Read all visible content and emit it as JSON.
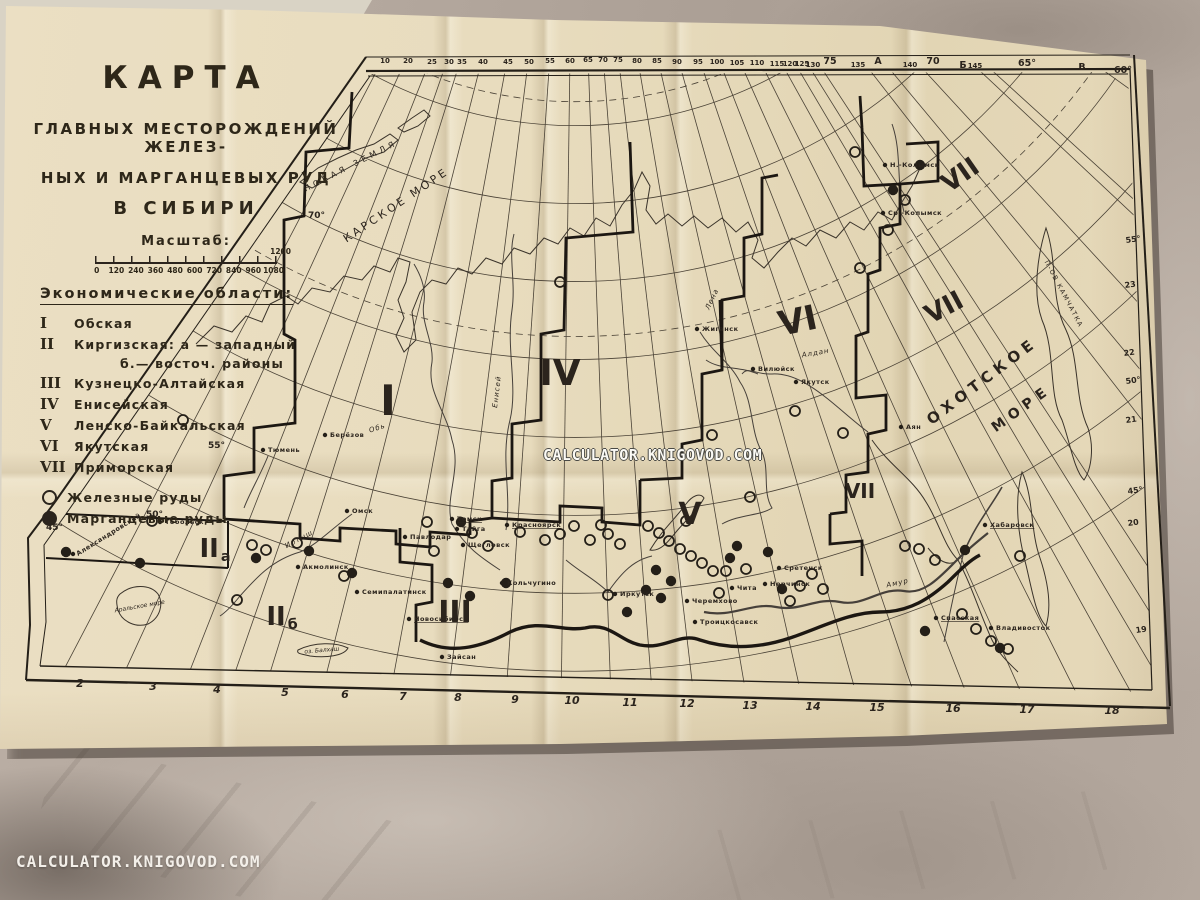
{
  "watermark": {
    "center": "CALCULATOR.KNIGOVOD.COM",
    "bottom_left": "CALCULATOR.KNIGOVOD.COM"
  },
  "colors": {
    "paper": "#e7dcbe",
    "ink": "#2b241d",
    "thin_line": "#3e372c",
    "table": "#b2a69c",
    "watermark_text": "#f6f3ec"
  },
  "title_block": {
    "title": "КАРТА",
    "subtitle_lines": [
      "ГЛАВНЫХ  МЕСТОРОЖДЕНИЙ  ЖЕЛЕЗ-",
      "НЫХ  И  МАРГАНЦЕВЫХ  РУД",
      "В  СИБИРИ"
    ],
    "scale_label": "Масштаб:",
    "scale_ticks": [
      "0",
      "120",
      "240",
      "360",
      "480",
      "600",
      "720",
      "840",
      "960",
      "1080"
    ],
    "scale_end": "1200"
  },
  "legend": {
    "heading": "Экономические области:",
    "items": [
      {
        "numeral": "I",
        "name": "Обская",
        "indent": false
      },
      {
        "numeral": "II",
        "name": "Киргизская: а — западный",
        "indent": false
      },
      {
        "numeral": "",
        "name": "б.— восточ. районы",
        "indent": true
      },
      {
        "numeral": "III",
        "name": "Кузнецко-Алтайская",
        "indent": false
      },
      {
        "numeral": "IV",
        "name": "Енисейская",
        "indent": false
      },
      {
        "numeral": "V",
        "name": "Ленско-Байкальская",
        "indent": false
      },
      {
        "numeral": "VI",
        "name": "Якутская",
        "indent": false
      },
      {
        "numeral": "VII",
        "name": "Приморская",
        "indent": false
      }
    ],
    "ore_items": [
      {
        "type": "iron",
        "label": "Железные руды"
      },
      {
        "type": "manganese",
        "label": "Марганцевые руды"
      }
    ]
  },
  "map": {
    "meridian_top_x": [
      385,
      408,
      432,
      449,
      462,
      483,
      508,
      529,
      550,
      570,
      588,
      603,
      618,
      637,
      657,
      677,
      698,
      717,
      737,
      757,
      777,
      790,
      802,
      813,
      858,
      878,
      910,
      963,
      975,
      1082
    ],
    "parallel_radii": [
      426,
      504,
      582,
      660,
      738,
      816,
      894,
      972
    ],
    "dashed_radii": [
      402,
      637
    ],
    "top_edge": [
      {
        "t": "10",
        "x": 385,
        "y": 63
      },
      {
        "t": "20",
        "x": 408,
        "y": 63
      },
      {
        "t": "25",
        "x": 432,
        "y": 64
      },
      {
        "t": "30",
        "x": 449,
        "y": 64
      },
      {
        "t": "35",
        "x": 462,
        "y": 64
      },
      {
        "t": "40",
        "x": 483,
        "y": 64
      },
      {
        "t": "45",
        "x": 508,
        "y": 64
      },
      {
        "t": "50",
        "x": 529,
        "y": 64
      },
      {
        "t": "55",
        "x": 550,
        "y": 63
      },
      {
        "t": "60",
        "x": 570,
        "y": 63
      },
      {
        "t": "65",
        "x": 588,
        "y": 62
      },
      {
        "t": "70",
        "x": 603,
        "y": 62
      },
      {
        "t": "75",
        "x": 618,
        "y": 62
      },
      {
        "t": "80",
        "x": 637,
        "y": 63
      },
      {
        "t": "85",
        "x": 657,
        "y": 63
      },
      {
        "t": "90",
        "x": 677,
        "y": 64
      },
      {
        "t": "95",
        "x": 698,
        "y": 64
      },
      {
        "t": "100",
        "x": 717,
        "y": 64
      },
      {
        "t": "105",
        "x": 737,
        "y": 65
      },
      {
        "t": "110",
        "x": 757,
        "y": 65
      },
      {
        "t": "115",
        "x": 777,
        "y": 66
      },
      {
        "t": "120",
        "x": 790,
        "y": 66
      },
      {
        "t": "125",
        "x": 802,
        "y": 66
      },
      {
        "t": "130",
        "x": 813,
        "y": 67
      },
      {
        "t": "75",
        "x": 830,
        "y": 64,
        "big": 1
      },
      {
        "t": "135",
        "x": 858,
        "y": 67
      },
      {
        "t": "А",
        "x": 878,
        "y": 64,
        "big": 1
      },
      {
        "t": "140",
        "x": 910,
        "y": 67
      },
      {
        "t": "70",
        "x": 933,
        "y": 64,
        "big": 1
      },
      {
        "t": "Б",
        "x": 963,
        "y": 68,
        "big": 1
      },
      {
        "t": "145",
        "x": 975,
        "y": 68
      },
      {
        "t": "65°",
        "x": 1027,
        "y": 66,
        "big": 1
      },
      {
        "t": "В",
        "x": 1082,
        "y": 70,
        "big": 1
      },
      {
        "t": "60°",
        "x": 1123,
        "y": 73,
        "big": 1
      }
    ],
    "bottom_edge": [
      {
        "t": "2",
        "x": 80,
        "y": 676
      },
      {
        "t": "3",
        "x": 153,
        "y": 679
      },
      {
        "t": "4",
        "x": 217,
        "y": 682
      },
      {
        "t": "5",
        "x": 285,
        "y": 685
      },
      {
        "t": "6",
        "x": 345,
        "y": 687
      },
      {
        "t": "7",
        "x": 403,
        "y": 689
      },
      {
        "t": "8",
        "x": 458,
        "y": 690
      },
      {
        "t": "9",
        "x": 515,
        "y": 692
      },
      {
        "t": "10",
        "x": 572,
        "y": 693
      },
      {
        "t": "11",
        "x": 630,
        "y": 695
      },
      {
        "t": "12",
        "x": 687,
        "y": 696
      },
      {
        "t": "13",
        "x": 750,
        "y": 698
      },
      {
        "t": "14",
        "x": 813,
        "y": 699
      },
      {
        "t": "15",
        "x": 877,
        "y": 700
      },
      {
        "t": "16",
        "x": 953,
        "y": 701
      },
      {
        "t": "17",
        "x": 1027,
        "y": 702
      },
      {
        "t": "18",
        "x": 1112,
        "y": 703
      }
    ],
    "right_edge": [
      {
        "t": "55°",
        "x": 1126,
        "y": 243
      },
      {
        "t": "23",
        "x": 1125,
        "y": 288
      },
      {
        "t": "22",
        "x": 1124,
        "y": 356
      },
      {
        "t": "50°",
        "x": 1126,
        "y": 384
      },
      {
        "t": "21",
        "x": 1126,
        "y": 423
      },
      {
        "t": "45°",
        "x": 1128,
        "y": 494
      },
      {
        "t": "20",
        "x": 1128,
        "y": 526
      },
      {
        "t": "19",
        "x": 1136,
        "y": 633
      }
    ],
    "lat_labels": [
      {
        "t": "70°",
        "x": 308,
        "y": 218
      },
      {
        "t": "55°",
        "x": 208,
        "y": 448
      },
      {
        "t": "50°",
        "x": 146,
        "y": 517
      },
      {
        "t": "45°",
        "x": 46,
        "y": 530
      }
    ],
    "sea_labels": [
      {
        "t": "НОВАЯ ЗЕМЛЯ",
        "x": 352,
        "y": 168,
        "fs": 8,
        "ls": 4,
        "rot": -27
      },
      {
        "t": "КАРСКОЕ МОРЕ",
        "x": 398,
        "y": 208,
        "fs": 11,
        "ls": 3,
        "rot": -34
      },
      {
        "t": "ОХОТСКОЕ",
        "x": 985,
        "y": 385,
        "fs": 15,
        "ls": 5,
        "rot": -37,
        "b": 1
      },
      {
        "t": "МОРЕ",
        "x": 1024,
        "y": 412,
        "fs": 14,
        "ls": 6,
        "rot": -36,
        "b": 1
      },
      {
        "t": "П-ОВ КАМЧАТКА",
        "x": 1062,
        "y": 295,
        "fs": 6.5,
        "ls": 1.5,
        "rot": 62
      }
    ],
    "river_labels": [
      {
        "t": "Обь",
        "x": 378,
        "y": 430,
        "rot": -18
      },
      {
        "t": "Иртыш",
        "x": 300,
        "y": 541,
        "rot": -28
      },
      {
        "t": "Енисей",
        "x": 499,
        "y": 392,
        "rot": -83
      },
      {
        "t": "Лена",
        "x": 714,
        "y": 300,
        "rot": -65
      },
      {
        "t": "Алдан",
        "x": 816,
        "y": 355,
        "rot": -10
      },
      {
        "t": "Амур",
        "x": 898,
        "y": 585,
        "rot": -12
      }
    ],
    "region_numerals": [
      {
        "t": "I",
        "x": 388,
        "y": 415,
        "s": 42
      },
      {
        "t": "II",
        "sub": "а",
        "x": 215,
        "y": 557,
        "s": 26
      },
      {
        "t": "II",
        "sub": "б",
        "x": 282,
        "y": 625,
        "s": 26
      },
      {
        "t": "III",
        "x": 455,
        "y": 622,
        "s": 30
      },
      {
        "t": "IV",
        "x": 560,
        "y": 385,
        "s": 36
      },
      {
        "t": "V",
        "x": 690,
        "y": 524,
        "s": 30
      },
      {
        "t": "VI",
        "x": 800,
        "y": 332,
        "s": 34,
        "rot": -12
      },
      {
        "t": "VII",
        "x": 948,
        "y": 315,
        "s": 26,
        "rot": -28
      },
      {
        "t": "VII",
        "x": 965,
        "y": 182,
        "s": 26,
        "rot": -35
      },
      {
        "t": "VII",
        "x": 860,
        "y": 498,
        "s": 20
      }
    ],
    "places": [
      {
        "n": "Берёзов",
        "x": 330,
        "y": 437
      },
      {
        "n": "Тюмень",
        "x": 268,
        "y": 452
      },
      {
        "n": "Тобольск",
        "x": 165,
        "y": 524
      },
      {
        "n": "Омск",
        "x": 352,
        "y": 513
      },
      {
        "n": "Павлодар",
        "x": 410,
        "y": 539
      },
      {
        "n": "Акмолинск",
        "x": 303,
        "y": 569
      },
      {
        "n": "Семипалатинск",
        "x": 362,
        "y": 594
      },
      {
        "n": "Новосибирск",
        "x": 414,
        "y": 621,
        "ul": 1
      },
      {
        "n": "Зайсан",
        "x": 447,
        "y": 659
      },
      {
        "n": "Томск",
        "x": 457,
        "y": 521,
        "ul": 1
      },
      {
        "n": "Тайга",
        "x": 462,
        "y": 531
      },
      {
        "n": "Щегловск",
        "x": 468,
        "y": 547
      },
      {
        "n": "Кольчугино",
        "x": 507,
        "y": 585
      },
      {
        "n": "Красноярск",
        "x": 512,
        "y": 527,
        "ul": 1
      },
      {
        "n": "Иркутск",
        "x": 620,
        "y": 596
      },
      {
        "n": "Черемхово",
        "x": 692,
        "y": 603
      },
      {
        "n": "Троицкосавск",
        "x": 700,
        "y": 624
      },
      {
        "n": "Чита",
        "x": 737,
        "y": 590
      },
      {
        "n": "Нерчинск",
        "x": 770,
        "y": 586
      },
      {
        "n": "Сретенск",
        "x": 784,
        "y": 570
      },
      {
        "n": "Якутск",
        "x": 801,
        "y": 384
      },
      {
        "n": "Вилюйск",
        "x": 758,
        "y": 371
      },
      {
        "n": "Жиганск",
        "x": 702,
        "y": 331
      },
      {
        "n": "Ср.-Колымск",
        "x": 888,
        "y": 215
      },
      {
        "n": "Н.-Колымск",
        "x": 890,
        "y": 167
      },
      {
        "n": "Аян",
        "x": 906,
        "y": 429
      },
      {
        "n": "Хабаровск",
        "x": 990,
        "y": 527,
        "ul": 1
      },
      {
        "n": "Спасская",
        "x": 941,
        "y": 620,
        "ul": 1
      },
      {
        "n": "Владивосток",
        "x": 996,
        "y": 630
      },
      {
        "n": "Александровский",
        "x": 78,
        "y": 556,
        "rot": -32
      }
    ],
    "lake_labels": [
      {
        "t": "Аральское море",
        "x": 140,
        "y": 608,
        "rot": -10
      },
      {
        "t": "оз. Балхаш",
        "x": 322,
        "y": 652,
        "rot": -5
      }
    ],
    "ore_points": {
      "iron": [
        [
          152,
          521
        ],
        [
          183,
          420
        ],
        [
          237,
          600
        ],
        [
          252,
          545
        ],
        [
          266,
          550
        ],
        [
          297,
          543
        ],
        [
          427,
          522
        ],
        [
          434,
          551
        ],
        [
          472,
          533
        ],
        [
          488,
          546
        ],
        [
          520,
          532
        ],
        [
          545,
          540
        ],
        [
          560,
          534
        ],
        [
          574,
          526
        ],
        [
          590,
          540
        ],
        [
          601,
          525
        ],
        [
          608,
          534
        ],
        [
          620,
          544
        ],
        [
          648,
          526
        ],
        [
          659,
          533
        ],
        [
          669,
          541
        ],
        [
          680,
          549
        ],
        [
          691,
          556
        ],
        [
          702,
          563
        ],
        [
          713,
          571
        ],
        [
          686,
          521
        ],
        [
          608,
          595
        ],
        [
          719,
          593
        ],
        [
          726,
          571
        ],
        [
          746,
          569
        ],
        [
          790,
          601
        ],
        [
          800,
          586
        ],
        [
          812,
          574
        ],
        [
          823,
          589
        ],
        [
          560,
          282
        ],
        [
          712,
          435
        ],
        [
          750,
          497
        ],
        [
          795,
          411
        ],
        [
          843,
          433
        ],
        [
          860,
          268
        ],
        [
          888,
          230
        ],
        [
          905,
          200
        ],
        [
          855,
          152
        ],
        [
          905,
          546
        ],
        [
          919,
          549
        ],
        [
          935,
          560
        ],
        [
          1020,
          556
        ],
        [
          962,
          614
        ],
        [
          976,
          629
        ],
        [
          991,
          641
        ],
        [
          1008,
          649
        ],
        [
          344,
          576
        ]
      ],
      "manganese": [
        [
          66,
          552
        ],
        [
          140,
          563
        ],
        [
          256,
          558
        ],
        [
          309,
          551
        ],
        [
          352,
          573
        ],
        [
          461,
          522
        ],
        [
          448,
          583
        ],
        [
          470,
          596
        ],
        [
          506,
          583
        ],
        [
          627,
          612
        ],
        [
          646,
          590
        ],
        [
          656,
          570
        ],
        [
          661,
          598
        ],
        [
          671,
          581
        ],
        [
          730,
          558
        ],
        [
          737,
          546
        ],
        [
          768,
          552
        ],
        [
          782,
          589
        ],
        [
          893,
          190
        ],
        [
          920,
          165
        ],
        [
          965,
          550
        ],
        [
          925,
          631
        ],
        [
          1000,
          648
        ]
      ]
    }
  }
}
